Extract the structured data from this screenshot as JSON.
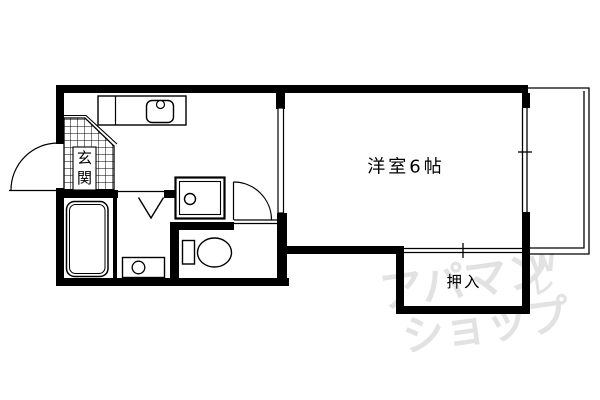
{
  "floorplan": {
    "background": "#ffffff",
    "line_color": "#000000",
    "labels": {
      "main_room": "洋室6帖",
      "closet": "押入",
      "entrance_char_1": "玄",
      "entrance_char_2": "関",
      "entrance": "玄関"
    },
    "fixtures": [
      "kitchen-counter",
      "kitchen-sink",
      "faucet",
      "bathtub",
      "bath-door-triangle",
      "washing-machine-pan",
      "washbasin",
      "toilet",
      "entrance-door-arc",
      "toilet-door-arc",
      "sliding-door-panel",
      "closet-sliding-door",
      "window",
      "balcony",
      "genkan-tiles"
    ],
    "watermark": {
      "line1": "アパマン",
      "line2": "ショップ",
      "mark_top": "W",
      "mark_bottom": "レ",
      "color": "#e2e2e2"
    }
  }
}
